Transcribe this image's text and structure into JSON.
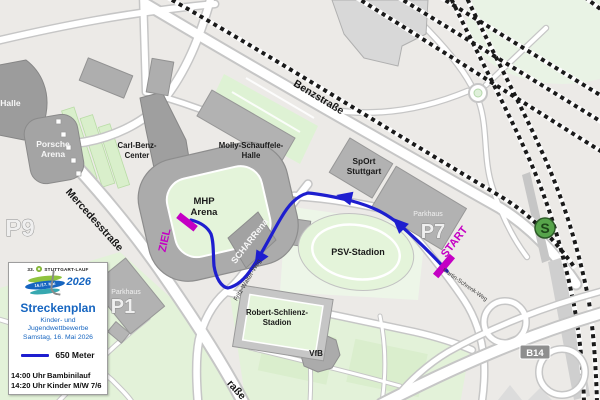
{
  "colors": {
    "route_blue": "#1e1ecf",
    "marker_magenta": "#c400c4",
    "legend_blue": "#1665c0",
    "logo_green": "#8fc33f",
    "sbahn_green": "#57a44b",
    "field_green": "#e4f4da",
    "building_gray": "#b2b2b2",
    "street_white": "#ffffff",
    "background_gray": "#eceae7",
    "railway_black": "#1a1a1a",
    "road_badge_gray": "#8e8e8e"
  },
  "legend": {
    "logo": {
      "edition": "33.",
      "name": "STUTTGART-LAUF",
      "year": "2026",
      "dates": "16./17. Mai"
    },
    "title": "Streckenplan",
    "subtitle_line1": "Kinder- und Jugendwettbewerbe",
    "subtitle_line2": "Samstag, 16. Mai 2026",
    "distance_label": "650 Meter",
    "schedule": [
      {
        "time": "14:00 Uhr",
        "event": "Bambinilauf"
      },
      {
        "time": "14:20 Uhr",
        "event": "Kinder M/W 7/6"
      }
    ]
  },
  "markers": {
    "start": "START",
    "finish": "ZIEL",
    "sbahn": "S",
    "road_badge": "B14"
  },
  "streets": {
    "benzstrasse": "Benzstraße",
    "mercedesstrasse": "Mercedesstraße",
    "mercedesstrasse_fragment": "raße",
    "fritz_walter_weg": "Fritz-Walter-Weg",
    "martin_schrenk_weg": "Martin-Schrenk-Weg"
  },
  "places": {
    "schleyer_halle_fragment": "-Halle",
    "porsche_arena": {
      "line1": "Porsche",
      "line2": "Arena"
    },
    "carl_benz_center": {
      "line1": "Carl-Benz-",
      "line2": "Center"
    },
    "molly_schauffele_halle": {
      "line1": "Molly-Schauffele-",
      "line2": "Halle"
    },
    "mhp_arena": {
      "line1": "MHP",
      "line2": "Arena"
    },
    "scharrena": "SCHARRena",
    "sport_stuttgart": {
      "line1": "SpOrt",
      "line2": "Stuttgart"
    },
    "psv_stadion": "PSV-Stadion",
    "robert_schlienz_stadion": {
      "line1": "Robert-Schlienz-",
      "line2": "Stadion"
    },
    "vfb": "VfB",
    "parkhaus_p7": {
      "label": "Parkhaus",
      "code": "P7"
    },
    "parkhaus_p1": {
      "label": "Parkhaus",
      "code": "P1"
    },
    "parkplatz_p9": "P9"
  }
}
